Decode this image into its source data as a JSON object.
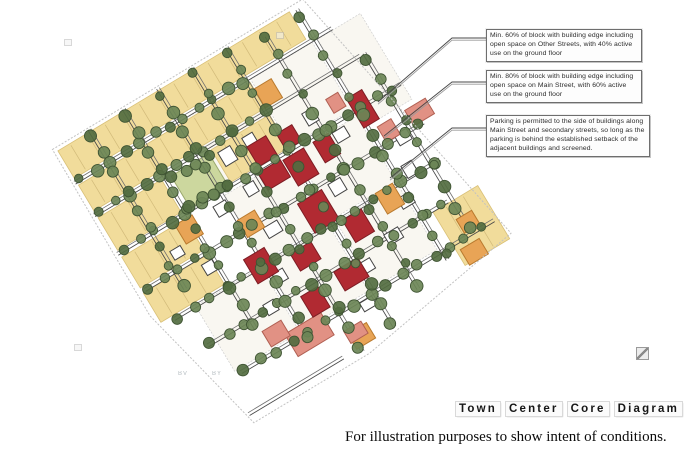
{
  "figure": {
    "callouts": [
      {
        "text": "Min. 60% of block with building edge including open space on Other Streets, with 40% active use on the ground floor"
      },
      {
        "text": "Min. 80% of block with building edge including open space on Main Street, with 60% active use on the ground floor"
      },
      {
        "text": "Parking is permitted to the side of buildings along Main Street and secondary streets, so long as the parking is behind the established setback of the adjacent buildings and screened."
      }
    ],
    "title_plate": {
      "words": [
        "Town",
        "Center",
        "Core",
        "Diagram"
      ]
    },
    "caption": "For illustration purposes to show intent of conditions.",
    "scan_marks": [
      "BV",
      "BY"
    ],
    "map": {
      "legend_colors": {
        "residential_block_yellow": "#f1dc9b",
        "park_green": "#ccd79e",
        "street_tree_green": "#6b8556",
        "street_tree_green_dark": "#526c40",
        "core_building_red": "#b12a32",
        "mixed_use_building_orange": "#e8a456",
        "secondary_building_salmon": "#e19184",
        "outline_building_white": "#ffffff",
        "street_line_gray": "#474747"
      }
    }
  }
}
